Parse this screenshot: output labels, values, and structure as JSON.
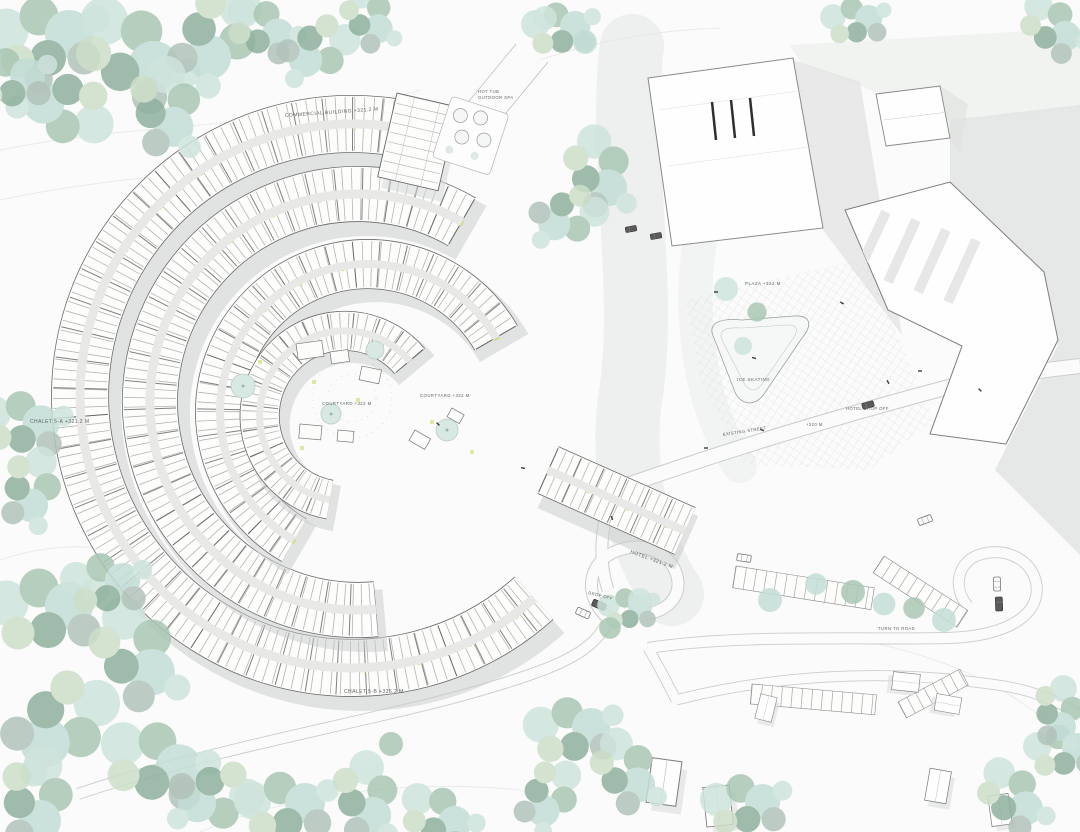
{
  "labels": {
    "commercial_building": "COMMERCIAL BUILDING +321.2 M",
    "hot_tub_line1": "HOT TUB",
    "hot_tub_line2": "OUTDOOR SPA",
    "chalet_a": "CHALET 5-A +321.2 M",
    "chalet_b": "CHALET 5-B +325.2 M",
    "hotel": "HOTEL +321.2 M",
    "plaza": "PLAZA +322 M",
    "ice_skating": "ICE SKATING",
    "hotel_drop_off": "HOTEL DROP OFF",
    "level_320": "+320 M",
    "existing_street": "EXISTING STREET",
    "courtyard_west": "COURTYARD +322 M",
    "courtyard_east": "COURTYARD +322 M",
    "drop_off": "DROP OFF",
    "turn_to_road": "TURN TO ROAD"
  },
  "colors": {
    "background": "#fafbfa",
    "tree_mint": "#cfe4dd",
    "tree_aqua": "#c3ded7",
    "tree_sage": "#a9c7b4",
    "tree_deep_sage": "#8fb19e",
    "tree_pale_green": "#cddfc9",
    "tree_gray_green": "#b2c3bb",
    "building_fill": "#fdfdfc",
    "wall_line": "#3c3c3c",
    "shadow_gray": "#c8cac9",
    "accent_green": "#cede82",
    "paving_grid": "#d9dcda",
    "label_text": "#5f6563"
  }
}
